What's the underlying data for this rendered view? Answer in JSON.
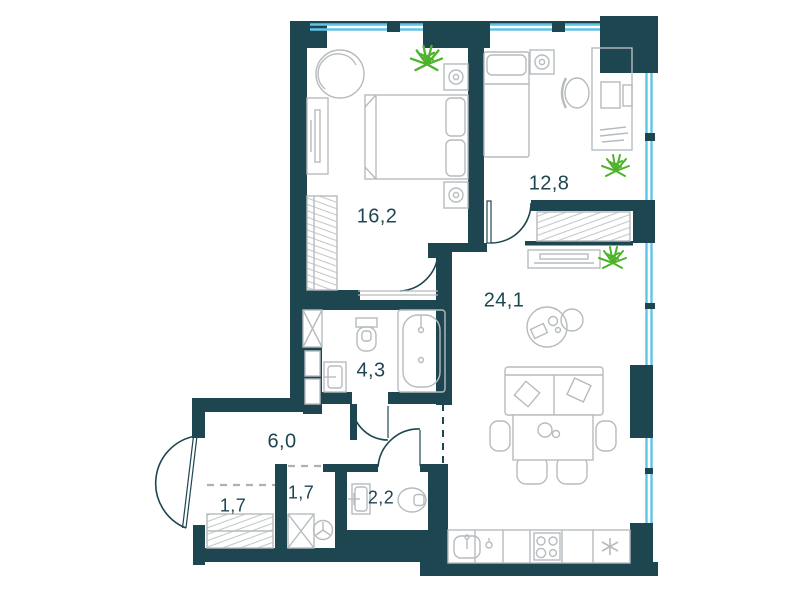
{
  "plan": {
    "title": "apartment-floor-plan",
    "colors": {
      "wall": "#1E4651",
      "window_glass": "#5FC4E6",
      "furniture_line": "#B6BBBE",
      "plant": "#4DB32A",
      "label_text": "#1E4651"
    },
    "rooms": [
      {
        "name": "living-room",
        "area": "24,1"
      },
      {
        "name": "bedroom",
        "area": "16,2"
      },
      {
        "name": "bedroom-2",
        "area": "12,8"
      },
      {
        "name": "hallway",
        "area": "6,0"
      },
      {
        "name": "bathroom",
        "area": "4,3"
      },
      {
        "name": "wc",
        "area": "2,2"
      },
      {
        "name": "wardrobe-1",
        "area": "1,7"
      },
      {
        "name": "wardrobe-2",
        "area": "1,7"
      }
    ]
  }
}
